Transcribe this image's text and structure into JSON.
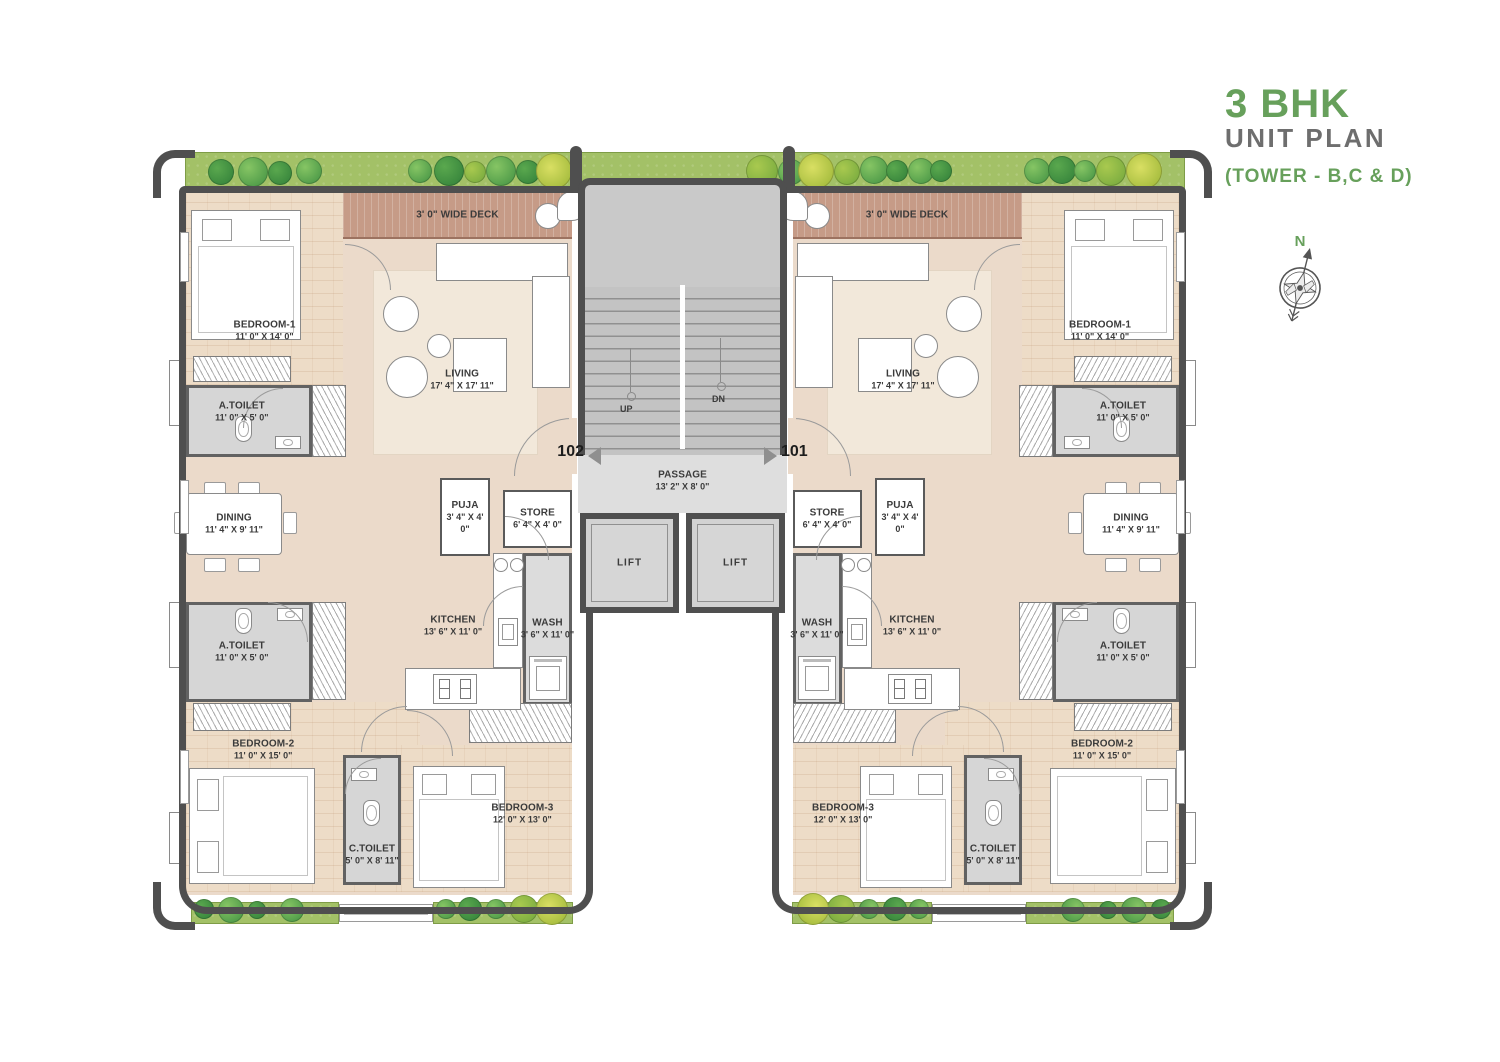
{
  "title": {
    "main": "3 BHK",
    "sub": "UNIT PLAN",
    "tower": "(TOWER - B,C & D)"
  },
  "compass": {
    "north": "N"
  },
  "colors": {
    "accent_green": "#67a05b",
    "wall": "#4f4f4f",
    "deck": "#c69b87",
    "floor_beige": "#ebdaca",
    "floor_brick": "#eddcc7",
    "toilet_gray": "#d6d6d6"
  },
  "core": {
    "stairs_up": "UP",
    "stairs_dn": "DN",
    "passage": {
      "name": "PASSAGE",
      "dims": "13' 2\" X 8' 0\""
    },
    "lift_left": "LIFT",
    "lift_right": "LIFT",
    "unit_left_number": "102",
    "unit_right_number": "101"
  },
  "rooms": {
    "deck": {
      "name": "3' 0\" WIDE DECK"
    },
    "bedroom1": {
      "name": "BEDROOM-1",
      "dims": "11' 0\" X 14' 0\""
    },
    "atoilet_top": {
      "name": "A.TOILET",
      "dims": "11' 0\" X 5' 0\""
    },
    "living": {
      "name": "LIVING",
      "dims": "17' 4\" X 17' 11\""
    },
    "dining": {
      "name": "DINING",
      "dims": "11' 4\" X 9' 11\""
    },
    "puja": {
      "name": "PUJA",
      "dims": "3' 4\" X 4' 0\""
    },
    "store": {
      "name": "STORE",
      "dims": "6' 4\" X 4' 0\""
    },
    "kitchen": {
      "name": "KITCHEN",
      "dims": "13' 6\" X 11' 0\""
    },
    "wash": {
      "name": "WASH",
      "dims": "3' 6\" X 11' 0\""
    },
    "atoilet_bottom": {
      "name": "A.TOILET",
      "dims": "11' 0\" X 5' 0\""
    },
    "bedroom2": {
      "name": "BEDROOM-2",
      "dims": "11' 0\" X 15' 0\""
    },
    "ctoilet": {
      "name": "C.TOILET",
      "dims": "5' 0\" X 8' 11\""
    },
    "bedroom3": {
      "name": "BEDROOM-3",
      "dims": "12' 0\" X 13' 0\""
    }
  }
}
